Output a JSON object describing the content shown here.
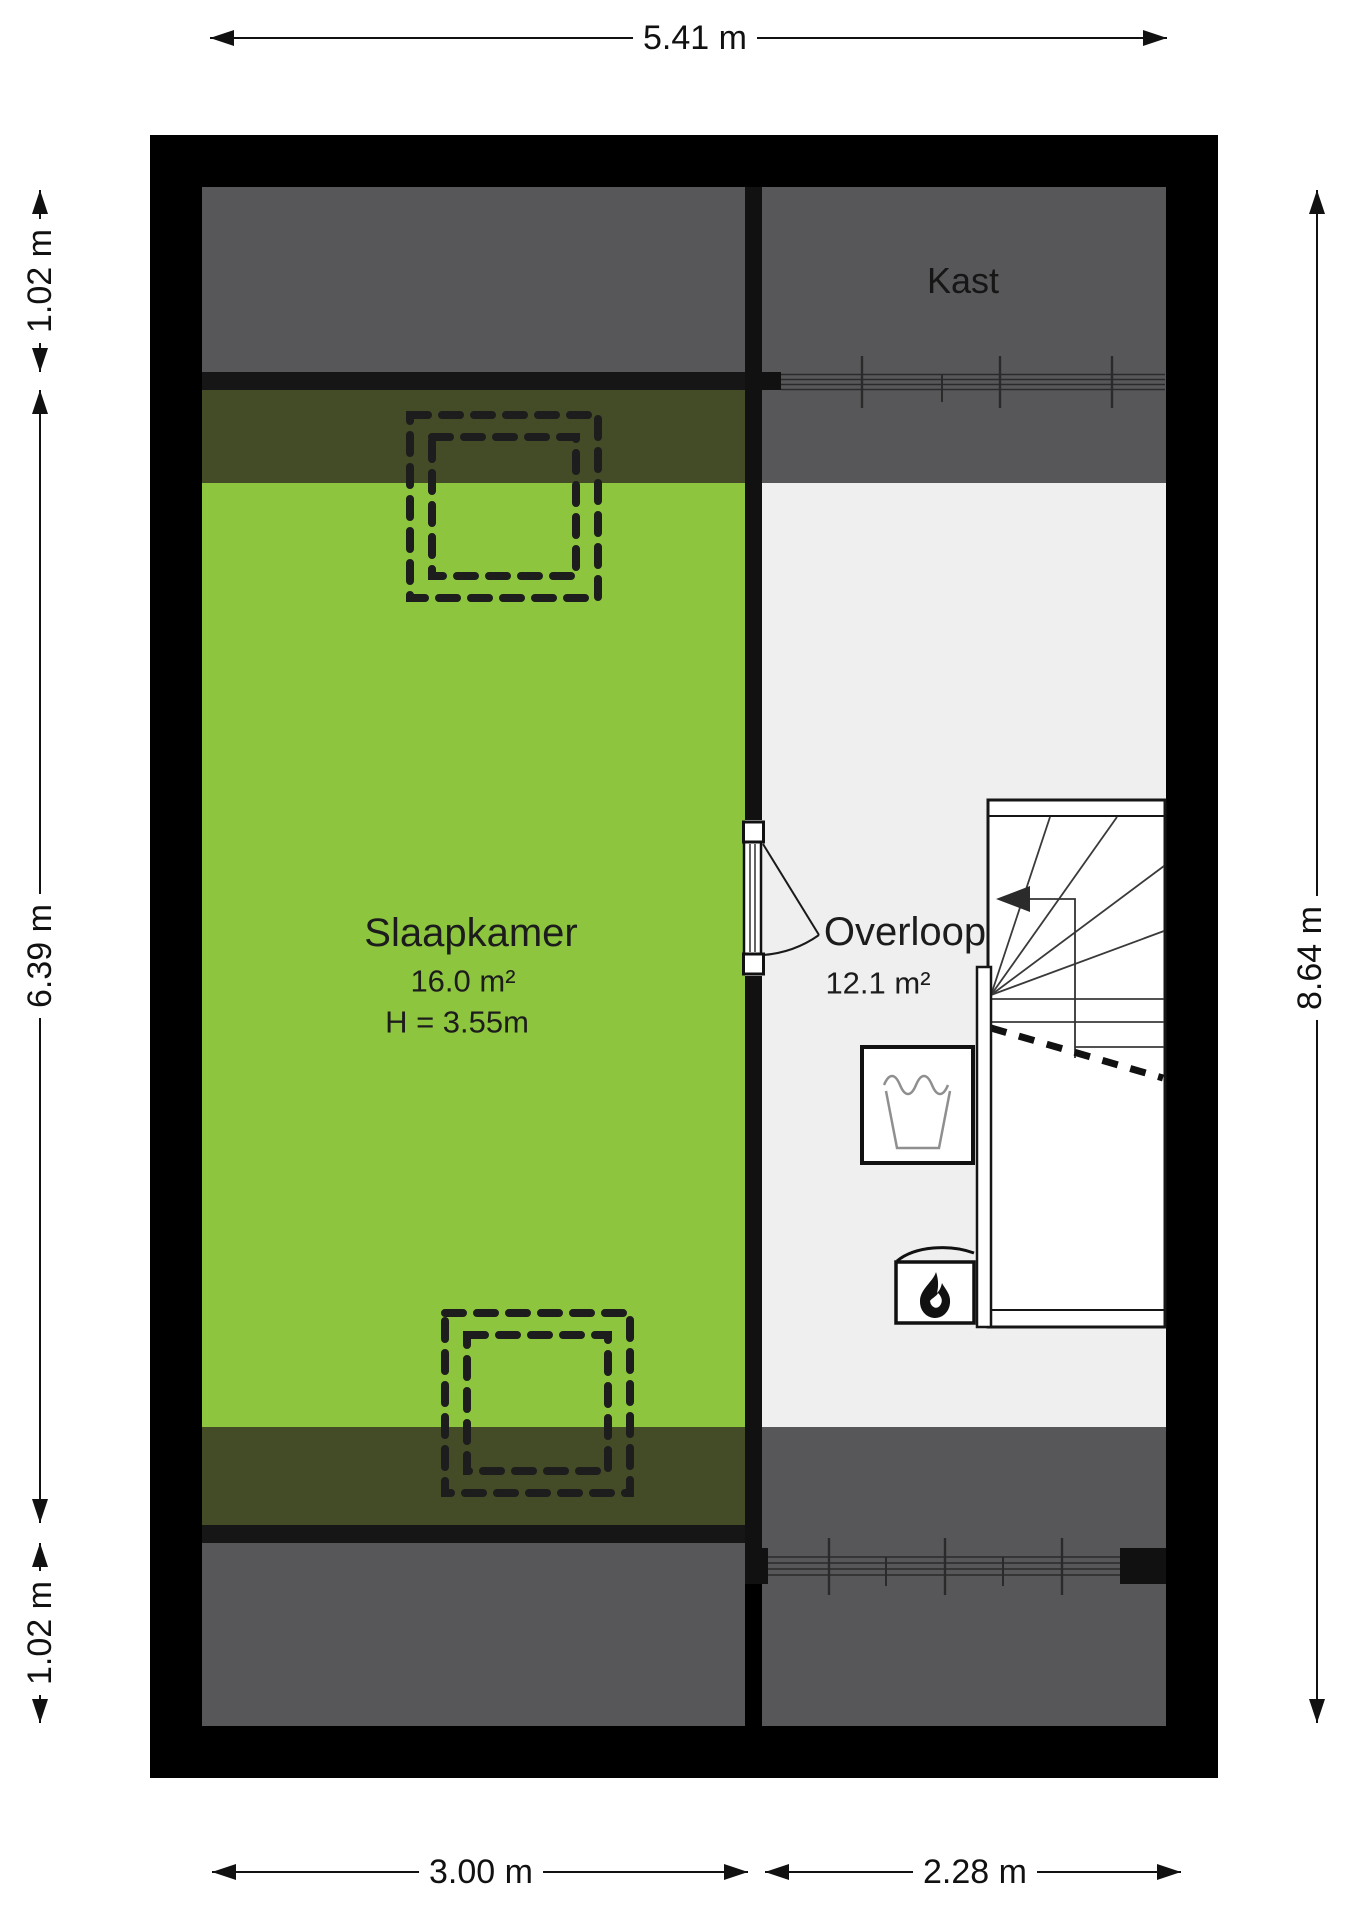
{
  "floorplan": {
    "rooms": [
      {
        "id": "slaapkamer",
        "name": "Slaapkamer",
        "area": "16.0 m²",
        "ceiling_height": "H = 3.55m"
      },
      {
        "id": "overloop",
        "name": "Overloop",
        "area": "12.1 m²"
      },
      {
        "id": "kast",
        "name": "Kast"
      }
    ],
    "dimensions": {
      "top_width": "5.41 m",
      "left_top": "1.02 m",
      "left_middle": "6.39 m",
      "left_bottom": "1.02 m",
      "right_height": "8.64 m",
      "bottom_left_width": "3.00 m",
      "bottom_right_width": "2.28 m"
    },
    "colors": {
      "bedroom_green": "#8dc53e",
      "low_headroom_olive": "#434b27",
      "attic_gray": "#57575a",
      "hall_floor_gray": "#efefef",
      "wall_black": "#000000"
    },
    "icons": [
      "washing-machine-icon",
      "boiler-flame-icon",
      "stairs-direction-arrow-icon",
      "skylight-dashed-outline",
      "window-symbol",
      "door-swing-symbol"
    ]
  }
}
